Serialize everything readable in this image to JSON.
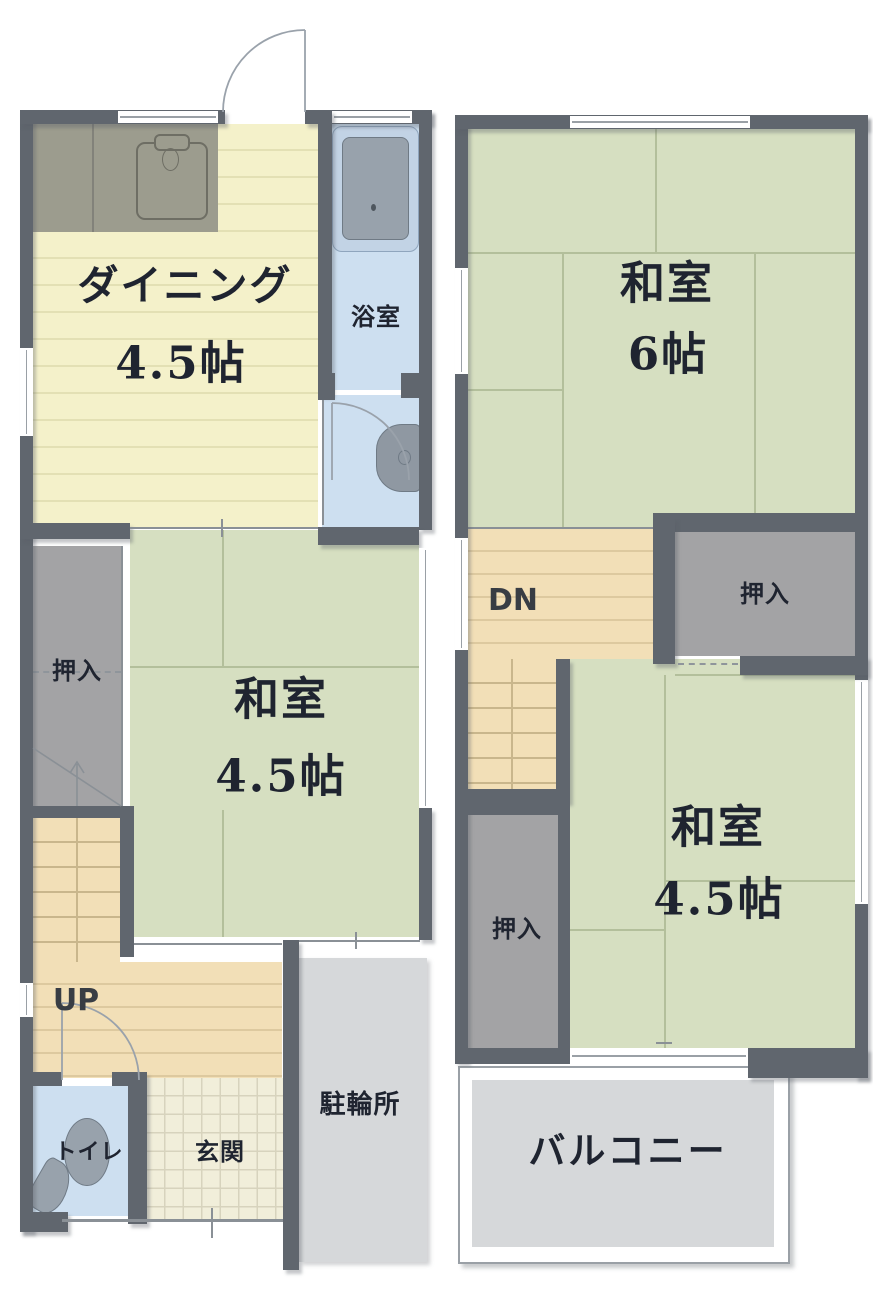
{
  "floor1": {
    "dining": {
      "name": "ダイニング",
      "size": "4.5帖"
    },
    "bath": {
      "name": "浴室"
    },
    "closet": {
      "name": "押入"
    },
    "washitsu": {
      "name": "和室",
      "size": "4.5帖"
    },
    "stairs": {
      "name": "UP"
    },
    "toilet": {
      "name": "トイレ"
    },
    "entrance": {
      "name": "玄関"
    },
    "bicycle_parking": {
      "name": "駐輪所"
    }
  },
  "floor2": {
    "washitsu6": {
      "name": "和室",
      "size": "6帖"
    },
    "stairs": {
      "name": "DN"
    },
    "closet_upper": {
      "name": "押入"
    },
    "washitsu45": {
      "name": "和室",
      "size": "4.5帖"
    },
    "closet_lower": {
      "name": "押入"
    },
    "balcony": {
      "name": "バルコニー"
    }
  },
  "colors": {
    "wall": "#60666e",
    "tatami_floor": "#d6dfc1",
    "dining_floor": "#f4f1ca",
    "wood_floor": "#f2dfb7",
    "water_area_floor": "#cddff0",
    "closet_fill": "#a3a3a5",
    "concrete": "#d6d8da",
    "entrance_tile": "#f1eeda",
    "label_text": "#1f2430"
  }
}
